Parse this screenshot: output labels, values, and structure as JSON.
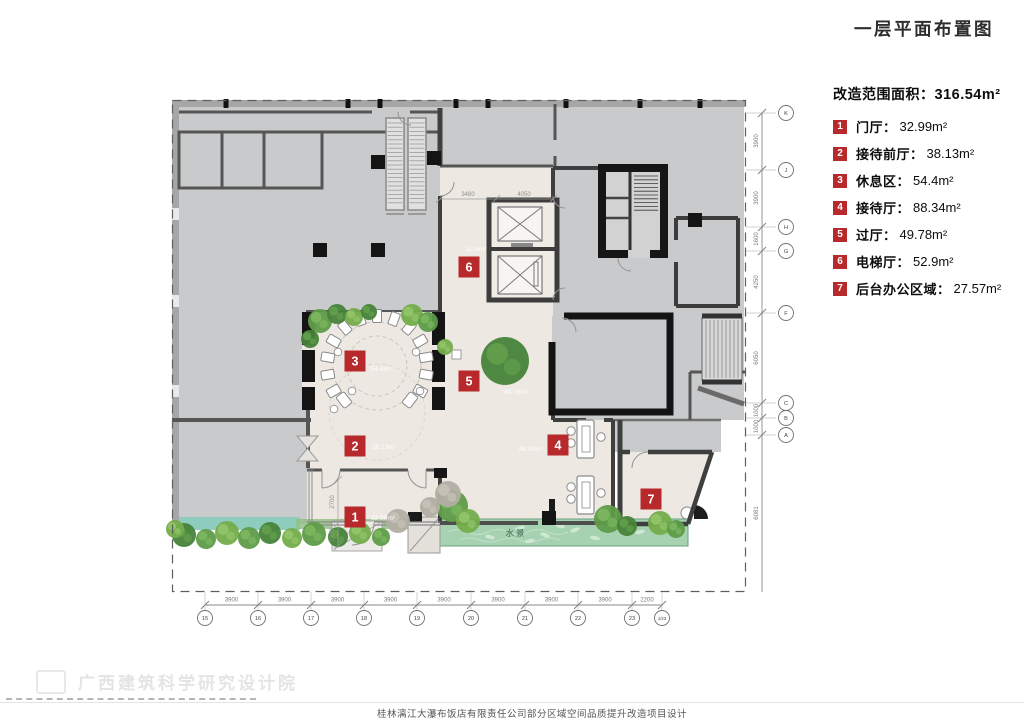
{
  "title": "一层平面布置图",
  "legend": {
    "header_label": "改造范围面积：",
    "header_value": "316.54m²",
    "items": [
      {
        "num": "1",
        "name": "门厅：",
        "value": "32.99m²"
      },
      {
        "num": "2",
        "name": "接待前厅：",
        "value": "38.13m²"
      },
      {
        "num": "3",
        "name": "休息区：",
        "value": "54.4m²"
      },
      {
        "num": "4",
        "name": "接待厅：",
        "value": "88.34m²"
      },
      {
        "num": "5",
        "name": "过厅：",
        "value": "49.78m²"
      },
      {
        "num": "6",
        "name": "电梯厅：",
        "value": "52.9m²"
      },
      {
        "num": "7",
        "name": "后台办公区域：",
        "value": "27.57m²"
      }
    ]
  },
  "plan": {
    "water_label": "水景",
    "markers": [
      {
        "num": "1",
        "area": "32.99m²"
      },
      {
        "num": "2",
        "area": "38.13m²"
      },
      {
        "num": "3",
        "area": "54.4m²"
      },
      {
        "num": "4",
        "area": "88.34m²"
      },
      {
        "num": "5",
        "area": "49.78m²"
      },
      {
        "num": "6",
        "area": "52.9m²"
      },
      {
        "num": "7",
        "area": "27.57m²"
      }
    ],
    "dims_bottom": [
      "3900",
      "3900",
      "3900",
      "3900",
      "3900",
      "3900",
      "3900",
      "3900",
      "2200"
    ],
    "grid_bottom": [
      "15",
      "16",
      "17",
      "18",
      "19",
      "20",
      "21",
      "22",
      "23",
      "1/23"
    ],
    "dims_right": [
      "3900",
      "3900",
      "1600",
      "4250",
      "6050",
      "1000",
      "1000",
      "6081"
    ],
    "grid_right": [
      "K",
      "J",
      "H",
      "G",
      "F",
      "C",
      "B",
      "A"
    ],
    "inner_dims": {
      "d1": "3480",
      "d2": "4050",
      "d3": "2700",
      "d4": "1500"
    }
  },
  "watermark": {
    "text": "广西建筑科学研究设计院"
  },
  "footer": {
    "caption": "桂林漓江大瀑布饭店有限责任公司部分区域空间品质提升改造项目设计"
  },
  "colors": {
    "accent_red": "#b8292b",
    "plan_gray": "#c9cacb",
    "renovation_beige": "#ede9e2",
    "wall_dark": "#3f3f3f",
    "water_green": "#a6d2b2",
    "plant_green": "#5e9c48"
  }
}
